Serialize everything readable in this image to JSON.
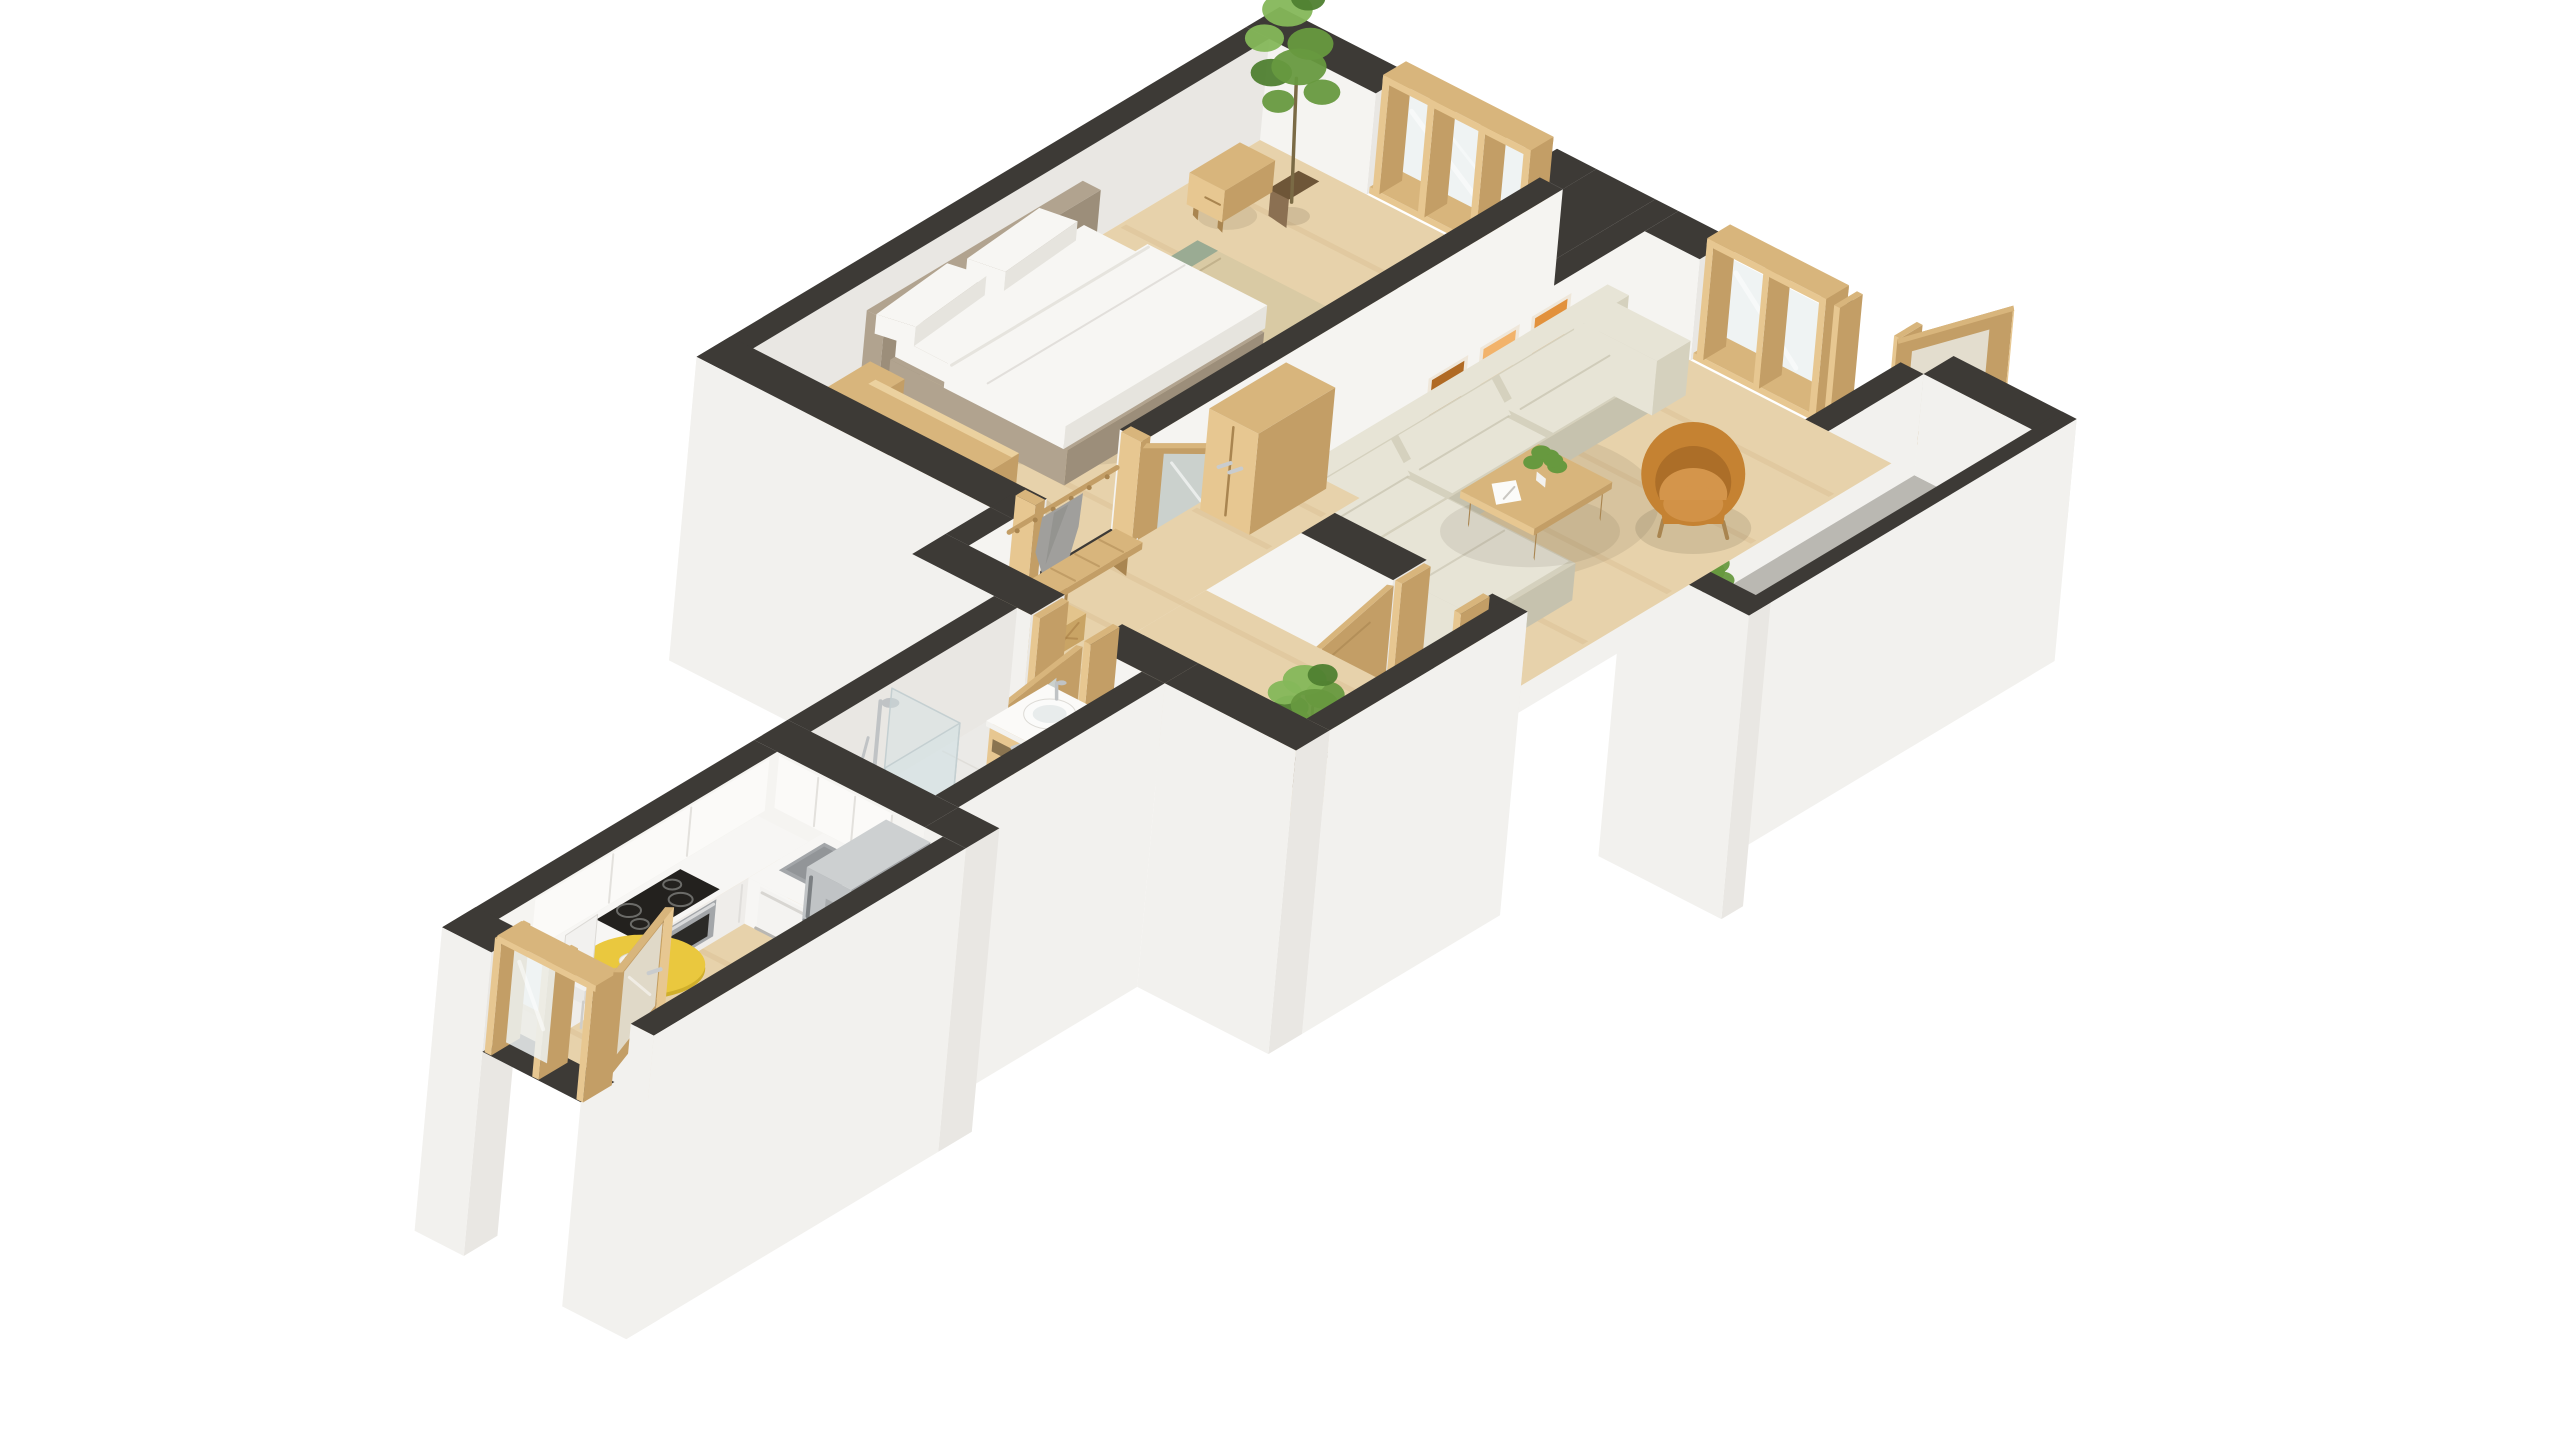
{
  "scene": {
    "label": "3D isometric floor plan of a one-bedroom apartment",
    "background": "#ffffff"
  },
  "palette": {
    "wallTop": "#3d3a36",
    "wallIn": "#f5f4f1",
    "wallIn2": "#e9e7e3",
    "wallExt": "#f2f1ee",
    "wallExt2": "#e7e5e1",
    "wallGrey": "#d8d6d2",
    "floorWood": "#e7d2ab",
    "floorWood2": "#dcc294",
    "floorBath": "#ebeae7",
    "floorBalcony": "#c0beb9",
    "oak": "#d8b57c",
    "oakLight": "#e7c791",
    "oakDark": "#c39e66",
    "oakDeep": "#a98550",
    "rug": "#d9caa4",
    "rugStripe": "#8aa38f",
    "headboard": "#b1a38f",
    "headboardDark": "#9c8e7a",
    "bedding": "#f7f6f3",
    "beddingShade": "#e6e4de",
    "sofa": "#e7e4d6",
    "sofaShade": "#d5d1be",
    "sofaDark": "#c6c2ae",
    "armchair": "#c58232",
    "armchairDark": "#a96b27",
    "armchairLight": "#d4954b",
    "steel": "#c0c3c5",
    "steelDark": "#a3a6a9",
    "steelDeep": "#878b8e",
    "applianceBlack": "#23211e",
    "counter": "#f7f6f4",
    "counterFront": "#efedea",
    "glass": "#edf2f2",
    "mirror": "#ccd6d8",
    "leafGreen": "#67993f",
    "leafDark": "#4f8030",
    "leafLight": "#85b75a",
    "potBrown": "#8b7052",
    "potGrey": "#b5b3af",
    "tableYellow": "#eac83e",
    "tableYellowDark": "#d0af2b",
    "poster1": "#e2913c",
    "poster2": "#f2b36b",
    "poster3": "#b06a24",
    "coat": "#a09f9c",
    "coatDark": "#8b8a87",
    "radiator": "#f1f0ee"
  },
  "rooms": [
    {
      "id": "bedroom",
      "label": "Bedroom",
      "furniture": [
        "double-bed",
        "headboard",
        "pillows",
        "nightstand",
        "nightstand",
        "sideboard",
        "area-rug",
        "tall-plant",
        "triple-window"
      ]
    },
    {
      "id": "living-room",
      "label": "Living Room",
      "furniture": [
        "sectional-sofa",
        "chaise",
        "coffee-table",
        "potted-plant",
        "open-magazine",
        "orange-armchair",
        "poster-triptych",
        "double-window",
        "open-balcony-door"
      ]
    },
    {
      "id": "balcony",
      "label": "Balcony",
      "furniture": [
        "parapet",
        "corner-plant"
      ]
    },
    {
      "id": "hallway",
      "label": "Entry Hall",
      "furniture": [
        "wardrobe",
        "coat-rack",
        "hanging-coat",
        "slatted-bench",
        "storage-basket",
        "monstera-plant",
        "bedroom-door",
        "living-room-door"
      ]
    },
    {
      "id": "bathroom",
      "label": "Bathroom",
      "furniture": [
        "washbasin-vanity",
        "shower-enclosure",
        "towel-radiator",
        "mirror-door"
      ]
    },
    {
      "id": "kitchen",
      "label": "Kitchen",
      "furniture": [
        "l-shaped-counter",
        "induction-cooktop",
        "oven",
        "kitchen-sink",
        "dishwasher",
        "fridge-freezer",
        "round-yellow-table",
        "fruit-bowl",
        "white-chair",
        "glazed-terrace-door"
      ]
    }
  ]
}
